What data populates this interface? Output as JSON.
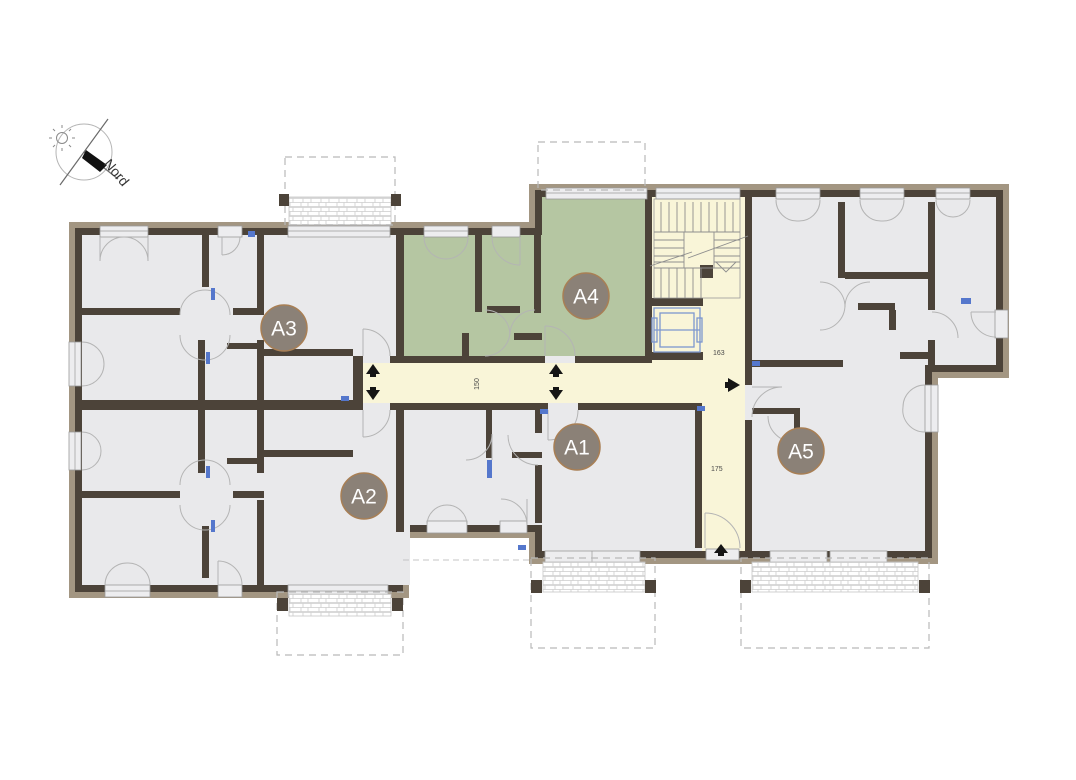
{
  "plan": {
    "compass": {
      "label": "Nord"
    },
    "units": [
      {
        "id": "A1",
        "highlighted": false
      },
      {
        "id": "A2",
        "highlighted": false
      },
      {
        "id": "A3",
        "highlighted": false
      },
      {
        "id": "A4",
        "highlighted": true
      },
      {
        "id": "A5",
        "highlighted": false
      }
    ],
    "highlighted_unit": "A4",
    "dimensions": [
      {
        "name": "corridor-width",
        "value": "150"
      },
      {
        "name": "stair-hall-width",
        "value": "163"
      },
      {
        "name": "entrance-hall-width",
        "value": "175"
      }
    ],
    "colors": {
      "wall": "#4c4339",
      "insulation_band": "#a39682",
      "room_fill": "#e9e9eb",
      "highlight_fill": "#b5c6a2",
      "circulation_fill": "#f9f5d8",
      "unit_badge_fill": "#8b8177",
      "unit_badge_ring": "#a87f55",
      "elevator_stroke": "#7d97cf",
      "accent_blue": "#5577cc"
    }
  }
}
